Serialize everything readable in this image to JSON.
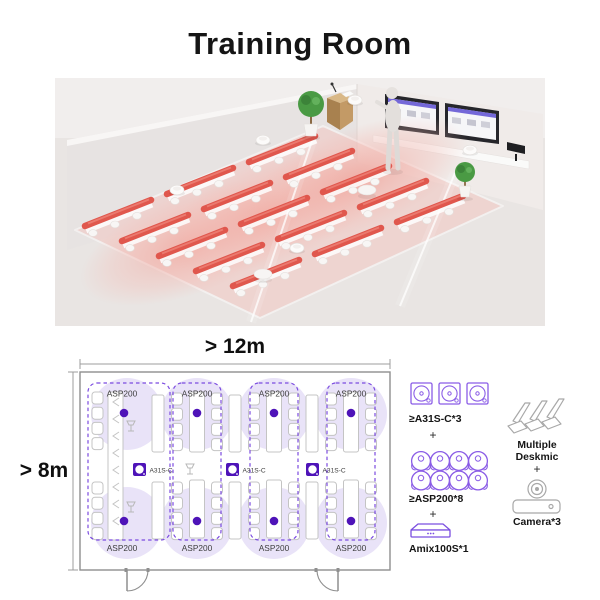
{
  "title": "Training Room",
  "colors": {
    "accent_purple": "#4e13b8",
    "zone_border_purple": "#7b4be0",
    "legend_icon_purple": "#8a5ce6",
    "coverage_lavender": "#e9e3f8",
    "desk_red": "#e0574d",
    "plan_gray": "#909090"
  },
  "plan": {
    "width_label": "> 12m",
    "height_label": "> 8m",
    "zones": [
      {
        "top": "ASP200",
        "bottom": "ASP200"
      },
      {
        "top": "ASP200",
        "bottom": "ASP200"
      },
      {
        "top": "ASP200",
        "bottom": "ASP200"
      },
      {
        "top": "ASP200",
        "bottom": "ASP200"
      }
    ],
    "mics": [
      "A31S-C",
      "A31S-C",
      "A31S-C"
    ]
  },
  "legend": {
    "column_speakers": {
      "label": "≥A31S-C*3",
      "icon": "square-speaker-icon",
      "count": 3
    },
    "plus1": "+",
    "ceiling_speakers": {
      "label": "≥ASP200*8",
      "icon": "round-speaker-icon",
      "count": 8
    },
    "plus2": "+",
    "mixer": {
      "label": "Amix100S*1",
      "icon": "mixer-box-icon",
      "count": 1
    },
    "deskmic": {
      "label_line1": "Multiple",
      "label_line2": "Deskmic",
      "icon": "desk-mic-icon"
    },
    "plus3": "+",
    "camera": {
      "label": "Camera*3",
      "icon": "ptz-camera-icon",
      "count": 3
    }
  }
}
